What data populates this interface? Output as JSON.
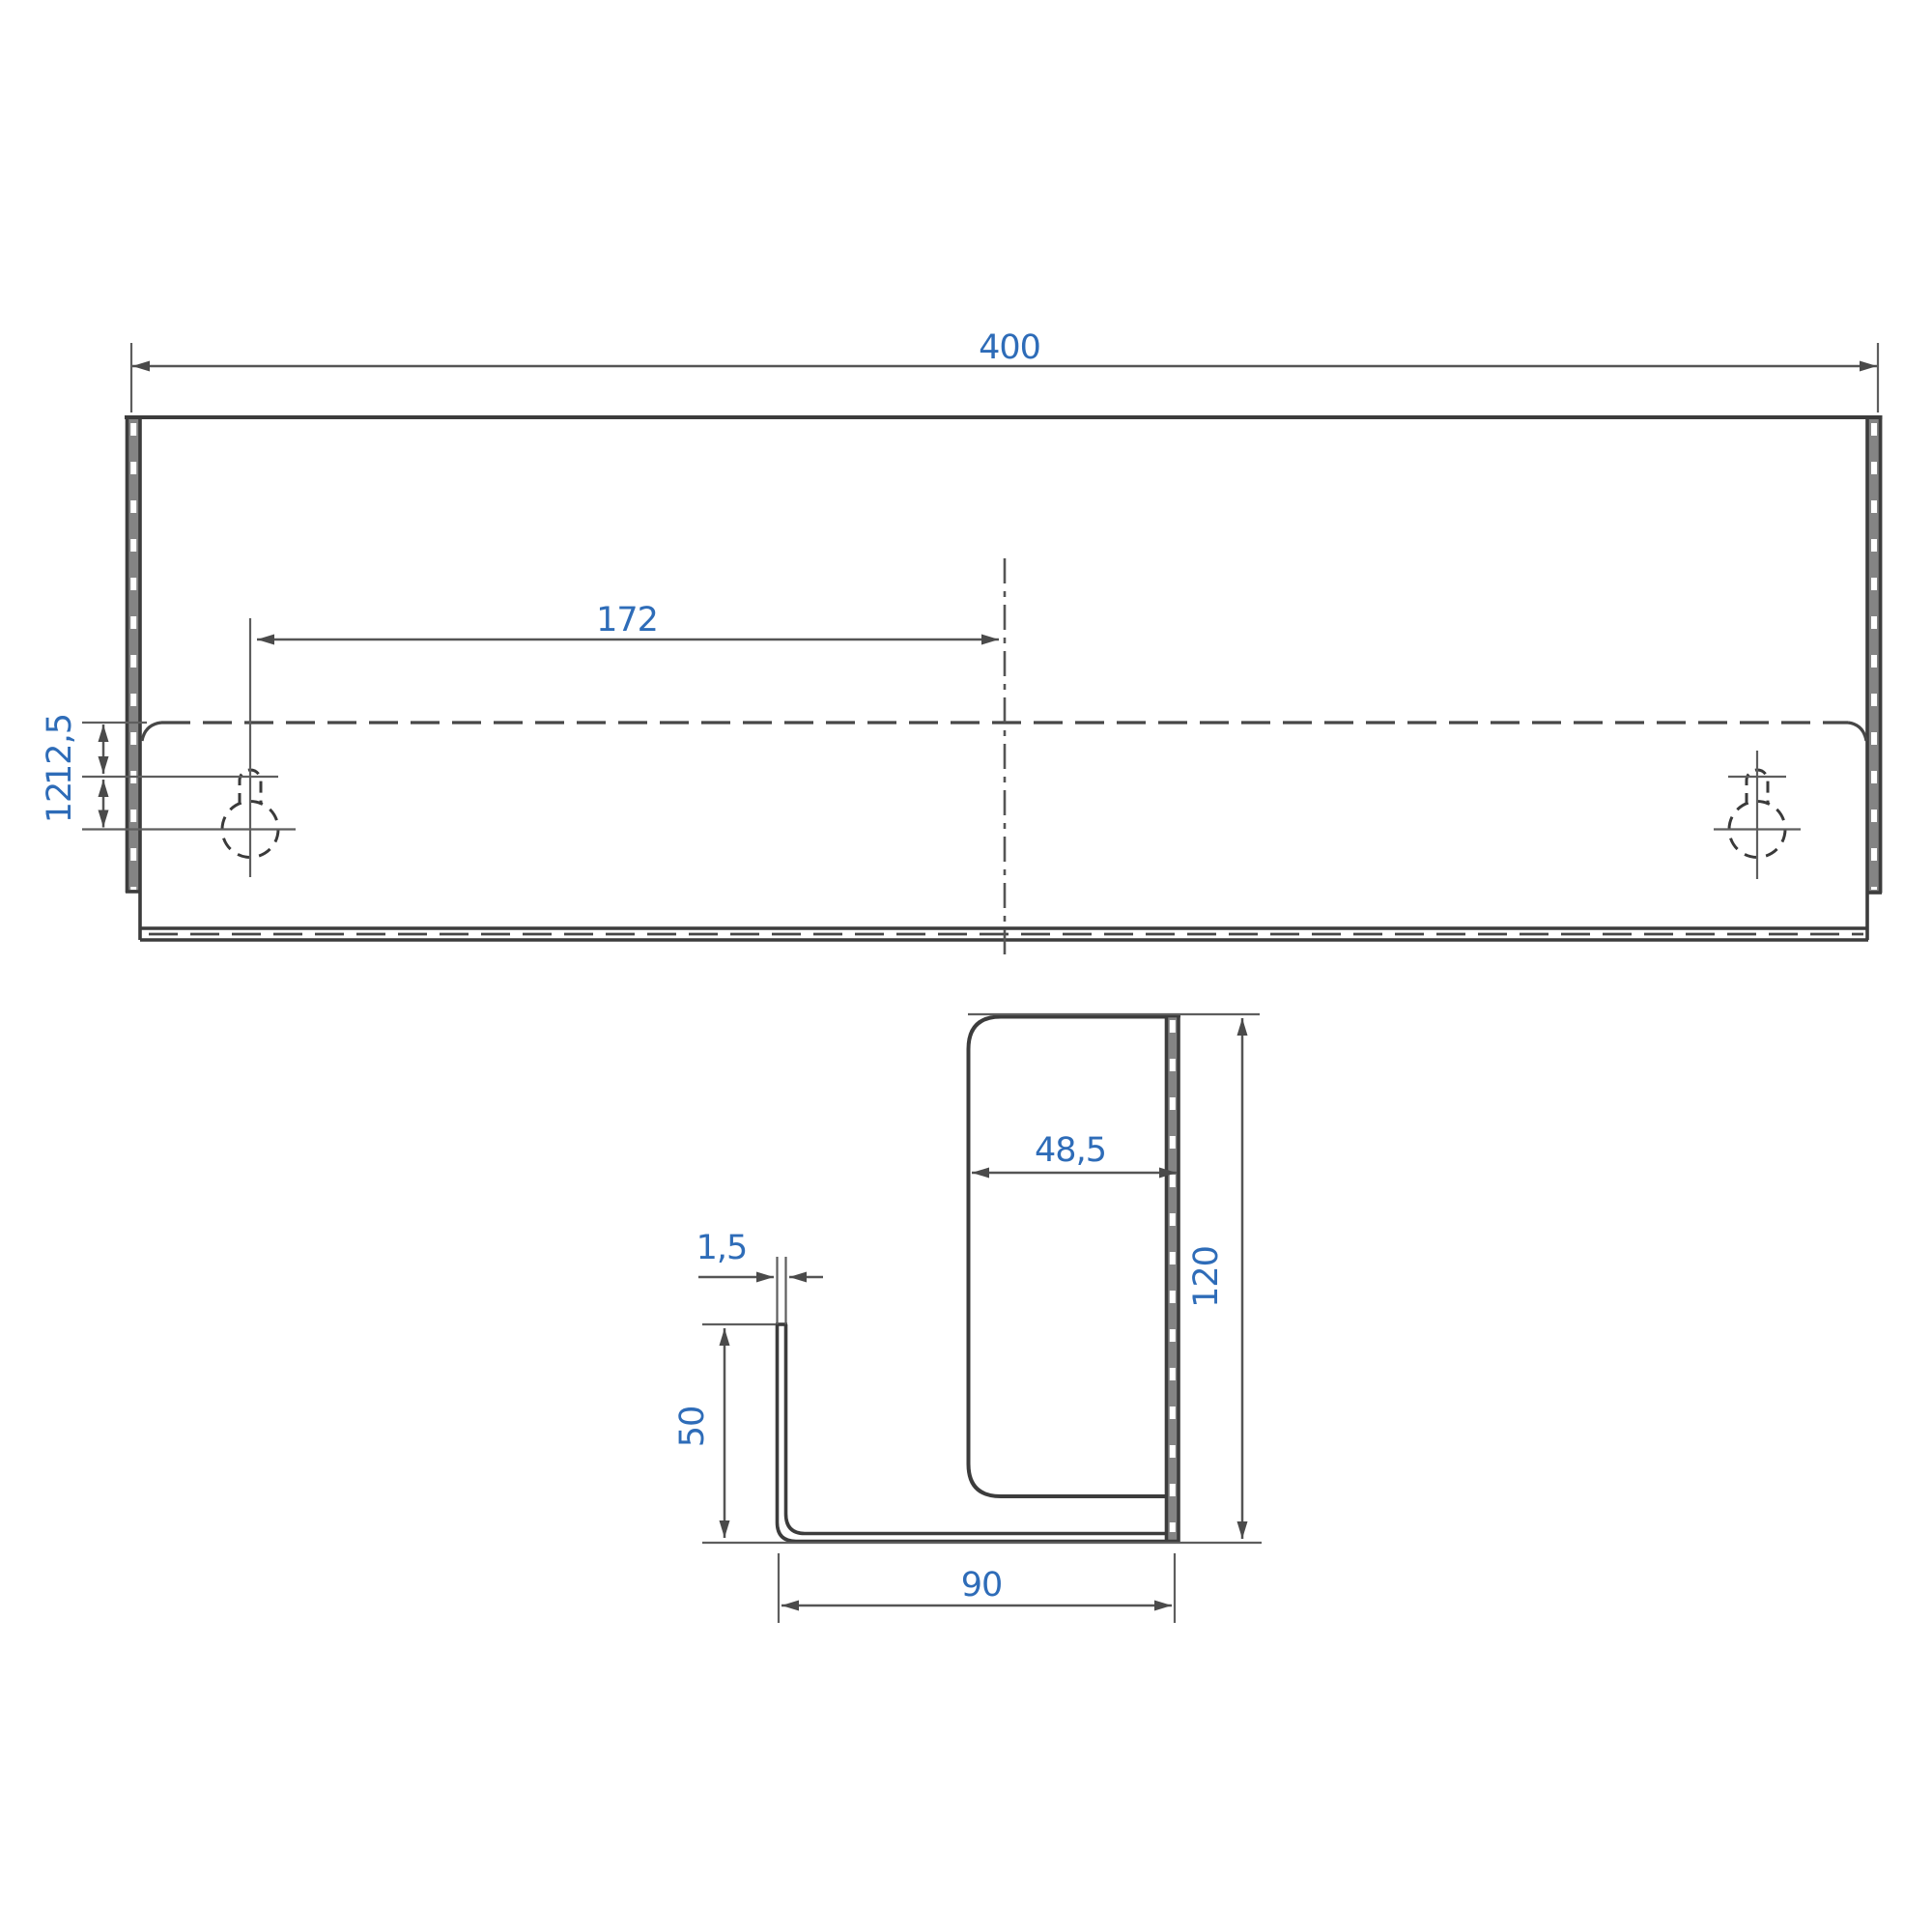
{
  "drawing_title": "Wall bracket technical drawing, front view and section profile",
  "front_view": {
    "labels": {
      "overall_width": "400",
      "hole_to_centerline": "172",
      "slot_top_offset": "12,5",
      "hole_center_offset": "12"
    }
  },
  "section_view": {
    "labels": {
      "pocket_depth": "48,5",
      "overall_height": "120",
      "material_thickness": "1,5",
      "front_height": "50",
      "base_depth": "90"
    }
  },
  "colors": {
    "background": "#ffffff",
    "object_line": "#3c3c3c",
    "thin_line": "#5e5e5e",
    "edge_band_fill": "#848484",
    "dimension_text": "#2e6cb8"
  }
}
